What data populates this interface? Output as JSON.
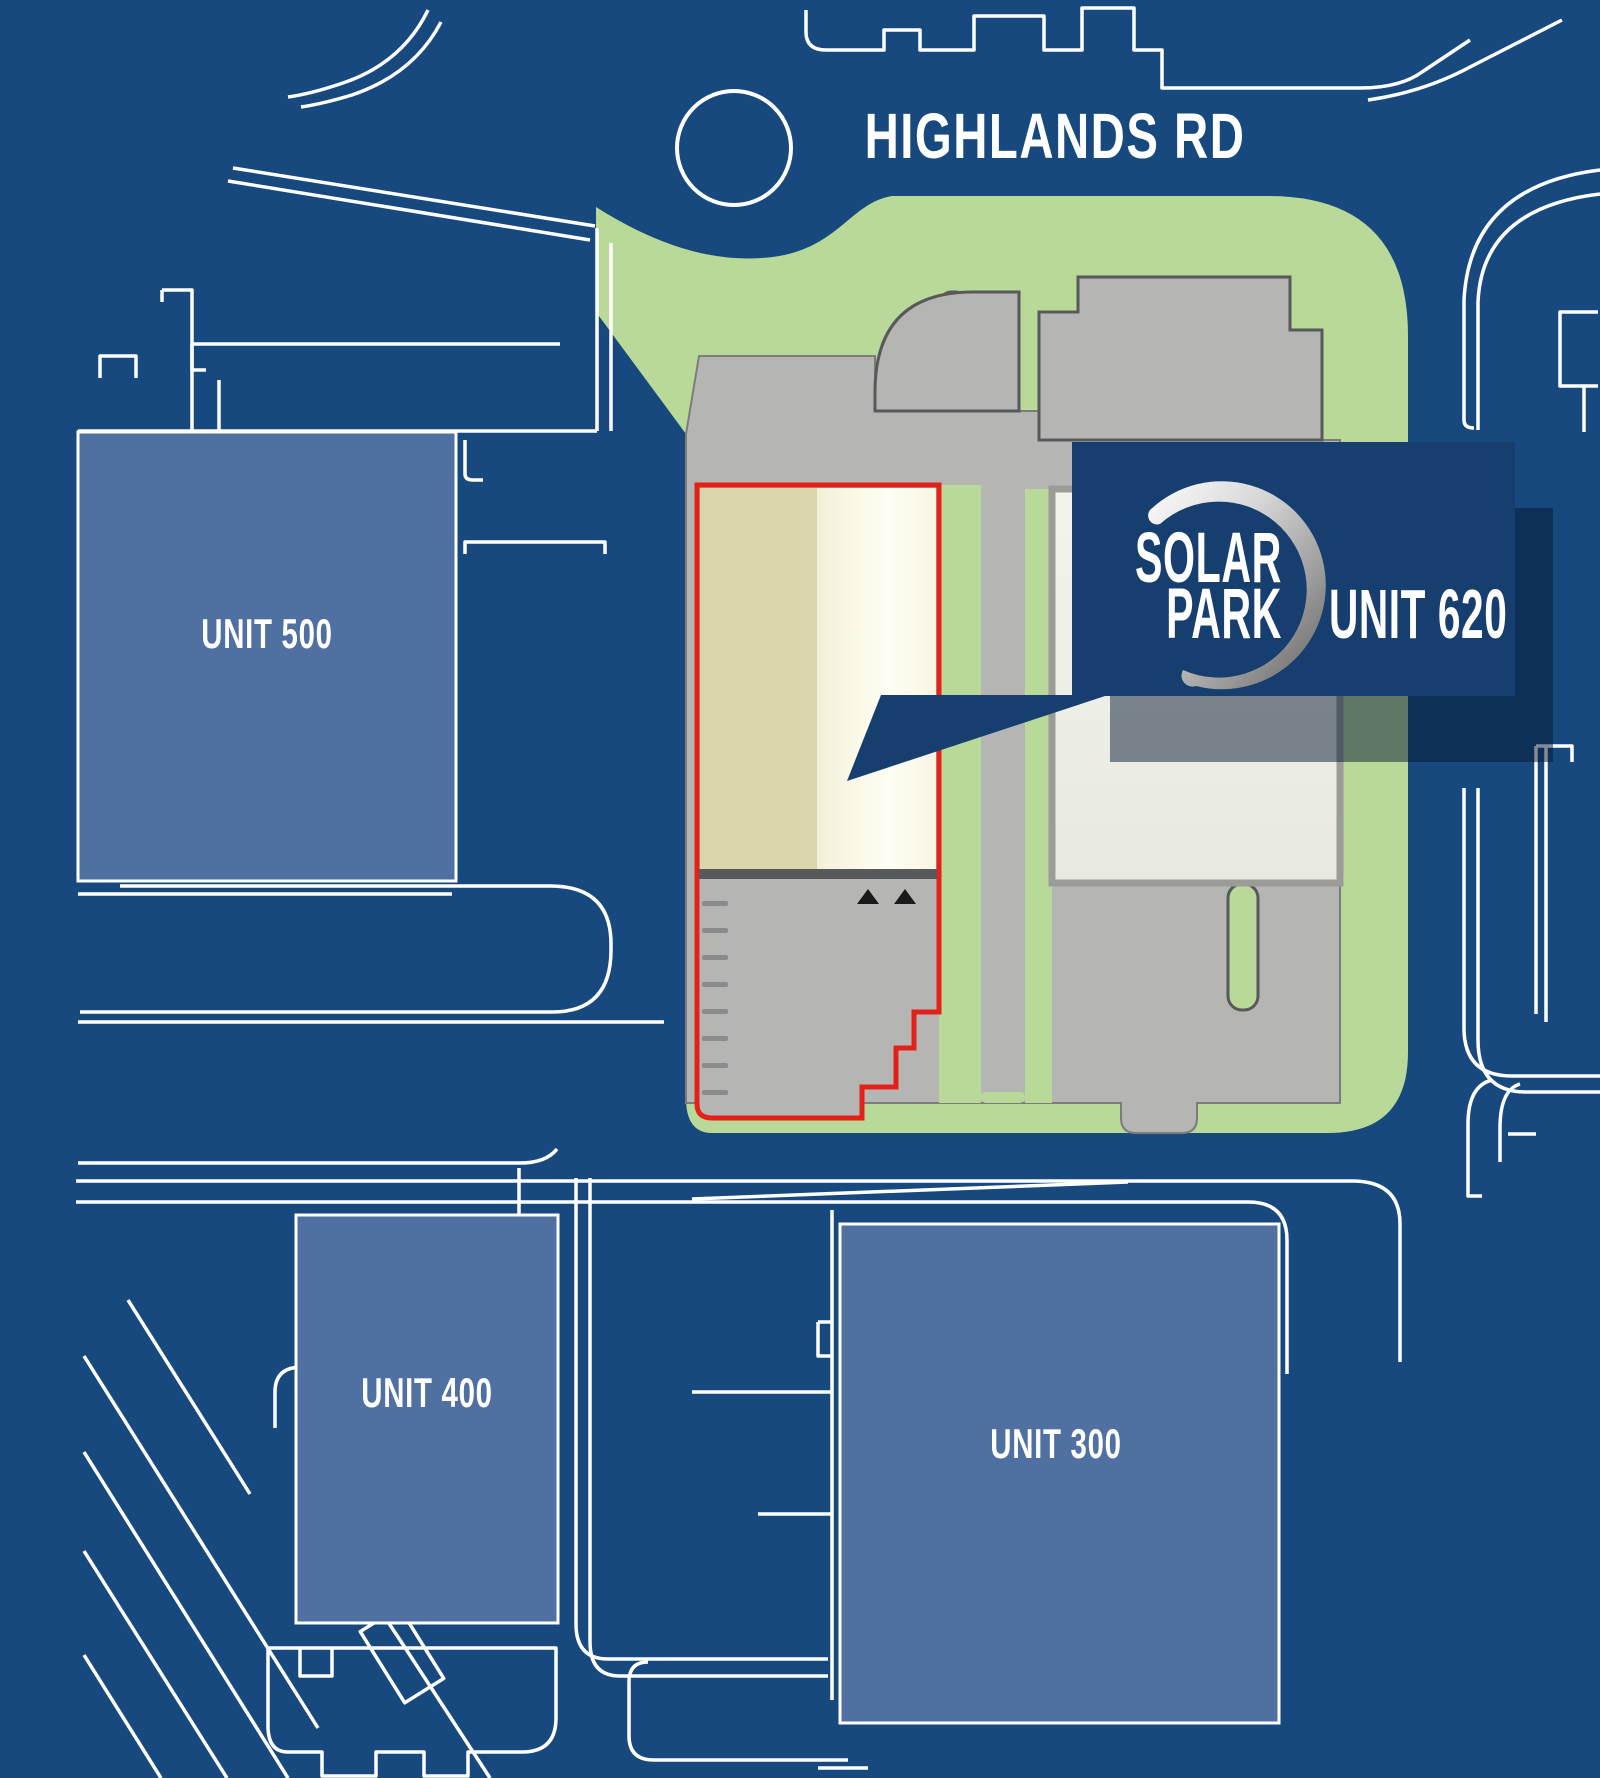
{
  "map": {
    "road_label": "HIGHLANDS RD",
    "units": {
      "unit500_label": "UNIT 500",
      "unit400_label": "UNIT 400",
      "unit300_label": "UNIT 300"
    },
    "callout": {
      "brand_line1": "SOLAR",
      "brand_line2": "PARK",
      "unit_label": "UNIT 620"
    },
    "legend": {
      "highlighted_unit": "UNIT 620",
      "highlight_outline": "red"
    },
    "colors": {
      "background": "#17497E",
      "linework": "#FFFFFF",
      "landscape_green": "#B9D998",
      "pavement_gray": "#B5B6B3",
      "pavement_outline": "#58595B",
      "unit_fill_blue": "#4F70A0",
      "building_beige": "#DBD5AB",
      "building_cream": "#FAF8E6",
      "building_light": "#EDEEE5",
      "building_border": "#9B9C98",
      "highlight_red": "#E32119",
      "callout_navy": "#163E6F",
      "logo_silver": "#C9C9C9",
      "dock_arrow_black": "#1A1A1A"
    }
  }
}
